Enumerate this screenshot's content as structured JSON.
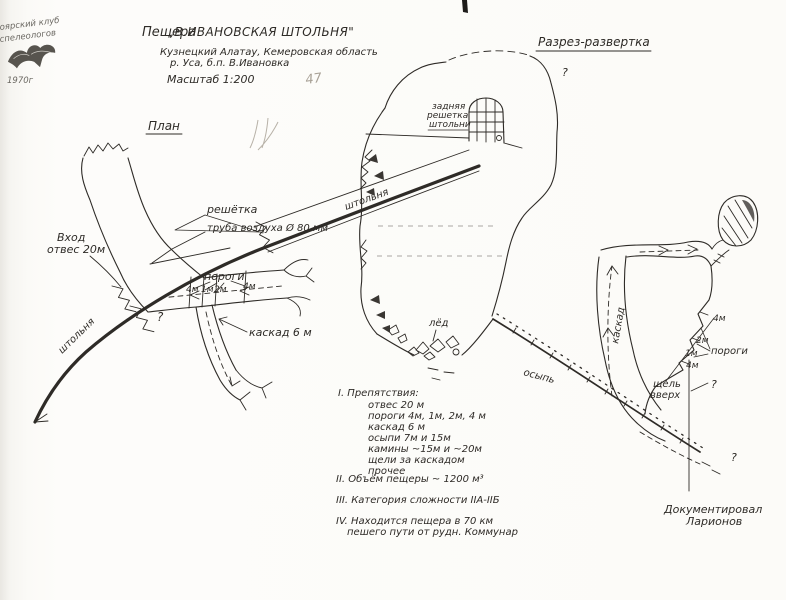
{
  "stamp": {
    "club_line1": "оярский клуб",
    "club_line2": "спелеологов",
    "year": "1970г"
  },
  "header": {
    "title_prefix": "Пещера",
    "title_name": "„В.ИВАНОВСКАЯ ШТОЛЬНЯ\"",
    "region": "Кузнецкий Алатау, Кемеровская область",
    "settlement": "р. Уса, б.п. В.Ивановка",
    "scale": "Масштаб 1:200",
    "pencil_note": "47"
  },
  "plan": {
    "heading": "План",
    "adit_label_upper": "штольня",
    "adit_label_lower": "штольня",
    "grate_label": "решётка",
    "air_pipe_label": "труба воздуха Ø 80 мм",
    "entrance_line1": "Вход",
    "entrance_line2": "отвес 20м",
    "rapids_label": "пороги",
    "tick_4m_a": "4м",
    "tick_1m": "1м",
    "tick_2m": "2м",
    "tick_4m_b": "4м",
    "cascade_label": "каскад 6 м",
    "question_mark": "?"
  },
  "section": {
    "heading": "Разрез-развертка",
    "question_top": "?",
    "back_grate_line1": "задняя",
    "back_grate_line2": "решетка",
    "back_grate_line3": "штольни",
    "ice_label": "лёд",
    "scree_label": "осыпь",
    "cascade_label": "каскад",
    "rapids_label": "пороги",
    "step_4m_top": "4м",
    "step_2m": "2м",
    "step_1m": "1м",
    "step_4m_low": "4м",
    "slit_line1": "щель",
    "slit_line2": "вверх",
    "question_right": "?",
    "question_bottom": "?"
  },
  "notes": {
    "obstacles_heading": "I. Препятствия:",
    "obstacles": [
      "отвес 20 м",
      "пороги 4м, 1м, 2м, 4 м",
      "каскад 6 м",
      "осыпи 7м и 15м",
      "камины ~15м и ~20м",
      "щели за каскадом",
      "прочее"
    ],
    "volume": "II. Объём пещеры ~ 1200 м³",
    "difficulty": "III. Категория сложности IIА-IIБ",
    "location_line1": "IV. Находится пещера в 70 км",
    "location_line2": "пешего пути от рудн. Коммунар"
  },
  "credit": {
    "line1": "Документировал",
    "line2": "Ларионов"
  }
}
